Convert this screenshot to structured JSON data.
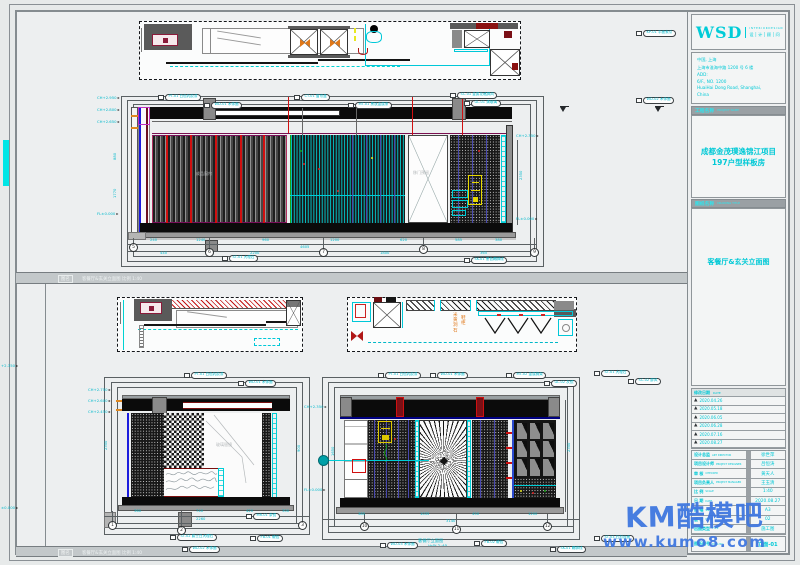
{
  "colors": {
    "accent_cyan": "#00c9d6",
    "line_red": "#d01010",
    "deep_blue": "#1c1cdd",
    "maroon": "#7a1016",
    "watermark_blue": "#3f77e0",
    "orange": "#e0791c"
  },
  "tb": {
    "logo": "WSD",
    "logo_en": "I N T E R I O R  D E S I G N",
    "logo_cn": "设│计│顾│问",
    "addr": [
      {
        "t": "中国, 上海"
      },
      {
        "t": "上海市淮海中路 1200 号 6 楼"
      },
      {
        "t": "ADD:"
      },
      {
        "t": "6/F., NO. 1200"
      },
      {
        "t": "HuaiHai Dong Road, Shanghai,"
      },
      {
        "t": "China"
      }
    ],
    "proj_h": "工程名称",
    "proj_h_en": "PROJECT NAME",
    "proj_l1": "成都金茂璞逸锦江项目",
    "proj_l2": "197户型样板房",
    "dwg_h": "图纸名称",
    "dwg_h_en": "DRAWING TITLE",
    "dwg_title": "客餐厅&玄关立面图",
    "rev_h": "修改日期",
    "rev_h_en": "DATE",
    "revisions": [
      {
        "t": "2020.04.26"
      },
      {
        "t": "2020.05.18"
      },
      {
        "t": "2020.06.05"
      },
      {
        "t": "2020.06.28"
      },
      {
        "t": "2020.07.16"
      },
      {
        "t": "2020.08.27"
      }
    ],
    "fields": [
      {
        "label": "设计总监",
        "en": "ART DIRECTOR",
        "value": "徐世萍"
      },
      {
        "label": "项目设计师",
        "en": "PROJECT DESIGNER",
        "value": "吕恒涛"
      },
      {
        "label": "审 核",
        "en": "CHECKED",
        "value": "黄天人"
      },
      {
        "label": "项目负责人",
        "en": "PROJECT MANAGER",
        "value": "王玉清"
      },
      {
        "label": "比 例",
        "en": "SCALE",
        "value": "1:40"
      },
      {
        "label": "日 期",
        "en": "DATE",
        "value": "2020.08.27"
      },
      {
        "label": "图 幅",
        "en": "SIZE",
        "value": "A3"
      },
      {
        "label": "版 次",
        "en": "ISSUE",
        "value": "02"
      },
      {
        "label": "出图类型",
        "en": "TYPE",
        "value": "施工图"
      }
    ],
    "dwgno_label": "图纸编号",
    "dwgno_en": "DWG NO.",
    "dwgno": "立面-01"
  },
  "bars": {
    "tag": "图名",
    "text": "客餐厅&玄关立面图  比例 1:40"
  },
  "wm": {
    "l1": "KM酷模吧",
    "l2": "www.kumo8.com"
  },
  "notes": {
    "curtain": "成品窗帘",
    "door": "移门预留",
    "mirror": "玻璃银镜",
    "orange1": "米黄洞石",
    "orange2": "鞋柜",
    "cap1": "客餐厅立面图",
    "cap2": "比例 1:40"
  },
  "rep": {
    "tags": [
      {
        "x": 158,
        "y": 94,
        "t": "PT-01 白色乳胶漆"
      },
      {
        "x": 204,
        "y": 102,
        "t": "WD-01 木饰面"
      },
      {
        "x": 294,
        "y": 94,
        "t": "CT-01 窗帘盒"
      },
      {
        "x": 348,
        "y": 102,
        "t": "MT-01 黑钛金属条"
      },
      {
        "x": 450,
        "y": 92,
        "t": "SC-01 金属花格屏风"
      },
      {
        "x": 464,
        "y": 100,
        "t": "GL-01 清玻璃"
      },
      {
        "x": 636,
        "y": 97,
        "t": "WD-02 木饰面"
      },
      {
        "x": 636,
        "y": 30,
        "t": "KP-01 平面索引"
      },
      {
        "x": 222,
        "y": 255,
        "t": "ST-01 大理石"
      },
      {
        "x": 464,
        "y": 257,
        "t": "SK-01 黑色踢脚线"
      },
      {
        "x": 184,
        "y": 372,
        "t": "PT-01 白色乳胶漆"
      },
      {
        "x": 238,
        "y": 380,
        "t": "WD-01 木饰面"
      },
      {
        "x": 246,
        "y": 513,
        "t": "MR-01 茶镜"
      },
      {
        "x": 170,
        "y": 534,
        "t": "ST-02 爵士白大理石"
      },
      {
        "x": 250,
        "y": 535,
        "t": "FB-01 硬包"
      },
      {
        "x": 182,
        "y": 546,
        "t": "WD-02 木饰面"
      },
      {
        "x": 378,
        "y": 372,
        "t": "PT-01 白色乳胶漆"
      },
      {
        "x": 430,
        "y": 372,
        "t": "WD-01 木饰面"
      },
      {
        "x": 506,
        "y": 372,
        "t": "MT-02 金属搁架"
      },
      {
        "x": 544,
        "y": 380,
        "t": "GL-02 灰镜"
      },
      {
        "x": 594,
        "y": 370,
        "t": "ST-01 大理石"
      },
      {
        "x": 628,
        "y": 378,
        "t": "SC-02 屏风"
      },
      {
        "x": 380,
        "y": 542,
        "t": "WD-03 木饰面"
      },
      {
        "x": 474,
        "y": 540,
        "t": "FB-02 硬包"
      },
      {
        "x": 550,
        "y": 546,
        "t": "SK-01 踢脚线"
      },
      {
        "x": 594,
        "y": 535,
        "t": "ST-03 石材台面"
      }
    ],
    "dims": [
      {
        "x": 150,
        "y": 239,
        "t": "240"
      },
      {
        "x": 196,
        "y": 239,
        "t": "1240"
      },
      {
        "x": 262,
        "y": 239,
        "t": "960"
      },
      {
        "x": 330,
        "y": 239,
        "t": "1200"
      },
      {
        "x": 400,
        "y": 239,
        "t": "620"
      },
      {
        "x": 455,
        "y": 239,
        "t": "585"
      },
      {
        "x": 495,
        "y": 239,
        "t": "380"
      },
      {
        "x": 300,
        "y": 246,
        "t": "4605"
      },
      {
        "x": 160,
        "y": 252,
        "t": "440"
      },
      {
        "x": 250,
        "y": 252,
        "t": "2200"
      },
      {
        "x": 380,
        "y": 252,
        "t": "1800"
      },
      {
        "x": 480,
        "y": 252,
        "t": "365"
      },
      {
        "x": 114,
        "y": 160,
        "t": "880",
        "r": -90
      },
      {
        "x": 114,
        "y": 198,
        "t": "1770",
        "r": -90
      },
      {
        "x": 520,
        "y": 180,
        "t": "2350",
        "r": -90
      },
      {
        "x": 134,
        "y": 510,
        "t": "360"
      },
      {
        "x": 196,
        "y": 510,
        "t": "740"
      },
      {
        "x": 246,
        "y": 510,
        "t": "420"
      },
      {
        "x": 282,
        "y": 510,
        "t": "300"
      },
      {
        "x": 196,
        "y": 518,
        "t": "2260"
      },
      {
        "x": 105,
        "y": 450,
        "t": "2350",
        "r": -90
      },
      {
        "x": 298,
        "y": 452,
        "t": "900",
        "r": -90
      },
      {
        "x": 358,
        "y": 513,
        "t": "385"
      },
      {
        "x": 420,
        "y": 513,
        "t": "1035"
      },
      {
        "x": 472,
        "y": 513,
        "t": "450"
      },
      {
        "x": 528,
        "y": 513,
        "t": "1200"
      },
      {
        "x": 446,
        "y": 520,
        "t": "3140"
      },
      {
        "x": 568,
        "y": 452,
        "t": "2350",
        "r": -90
      },
      {
        "x": 332,
        "y": 456,
        "t": "1650",
        "r": -90
      }
    ],
    "bubs": [
      {
        "x": 129,
        "y": 243,
        "t": "5"
      },
      {
        "x": 205,
        "y": 248,
        "t": "6"
      },
      {
        "x": 319,
        "y": 248,
        "t": "7"
      },
      {
        "x": 419,
        "y": 245,
        "t": "8"
      },
      {
        "x": 530,
        "y": 248,
        "t": "9"
      },
      {
        "x": 108,
        "y": 521,
        "t": "1"
      },
      {
        "x": 177,
        "y": 526,
        "t": "2"
      },
      {
        "x": 298,
        "y": 521,
        "t": "3"
      },
      {
        "x": 360,
        "y": 522,
        "t": "10"
      },
      {
        "x": 452,
        "y": 525,
        "t": "11"
      },
      {
        "x": 543,
        "y": 522,
        "t": "12"
      }
    ],
    "lvls": [
      {
        "x": 97,
        "y": 96,
        "t": "CH+2.950"
      },
      {
        "x": 97,
        "y": 108,
        "t": "CH+2.800"
      },
      {
        "x": 97,
        "y": 120,
        "t": "CH+2.650"
      },
      {
        "x": 97,
        "y": 212,
        "t": "FL±0.000"
      },
      {
        "x": 516,
        "y": 134,
        "t": "CH+2.350"
      },
      {
        "x": 516,
        "y": 217,
        "t": "FL±0.000"
      },
      {
        "x": 88,
        "y": 388,
        "t": "CH+2.750"
      },
      {
        "x": 88,
        "y": 399,
        "t": "CH+2.600"
      },
      {
        "x": 88,
        "y": 410,
        "t": "CH+2.450"
      },
      {
        "x": 304,
        "y": 405,
        "t": "CH+2.350"
      },
      {
        "x": 304,
        "y": 488,
        "t": "FL±0.000"
      },
      {
        "x": 1,
        "y": 364,
        "t": "+2.350"
      },
      {
        "x": 1,
        "y": 506,
        "t": "±0.000"
      }
    ]
  }
}
